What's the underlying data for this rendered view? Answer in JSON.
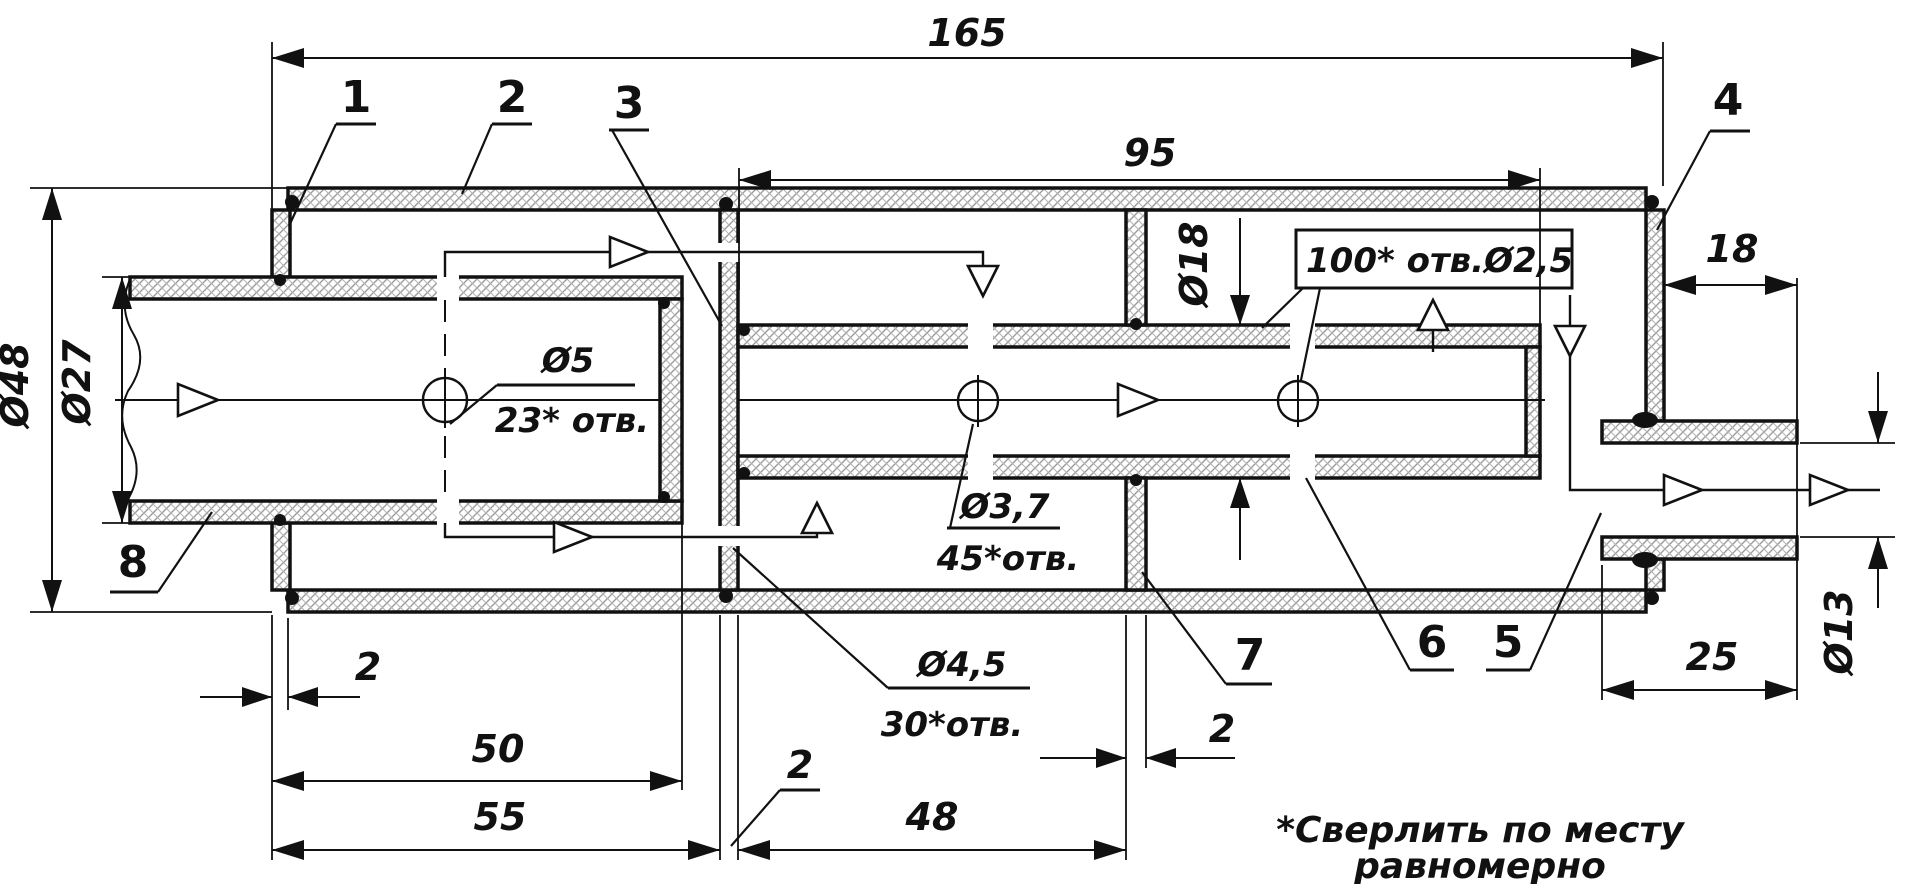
{
  "drawing": {
    "title": "muffler-cross-section",
    "units": "mm",
    "colors": {
      "ink": "#111111",
      "paper": "#ffffff",
      "hatch": "#9a9a9a"
    },
    "dims": {
      "total_length": "165",
      "tube_length": "95",
      "outlet_protrusion": "18",
      "outlet_length": "25",
      "inlet_section": "50",
      "front_section": "55",
      "middle_section": "48",
      "cap_thickness": "2",
      "partition3_thickness": "2",
      "partition7_thickness": "2",
      "outer_dia": "Ø48",
      "inlet_dia": "Ø27",
      "tube_dia": "Ø18",
      "outlet_dia": "Ø13"
    },
    "callouts": {
      "inlet_holes": {
        "dia": "Ø5",
        "count": "23* отв."
      },
      "tube_holes": {
        "dia": "Ø3,7",
        "count": "45*отв."
      },
      "partition_holes": {
        "dia": "Ø4,5",
        "count": "30*отв."
      },
      "outer_tube_holes": {
        "label": "100* отв.Ø2,5"
      }
    },
    "parts": {
      "p1": "1",
      "p2": "2",
      "p3": "3",
      "p4": "4",
      "p5": "5",
      "p6": "6",
      "p7": "7",
      "p8": "8"
    },
    "note": {
      "line1": "*Сверлить по месту",
      "line2": "равномерно"
    }
  }
}
